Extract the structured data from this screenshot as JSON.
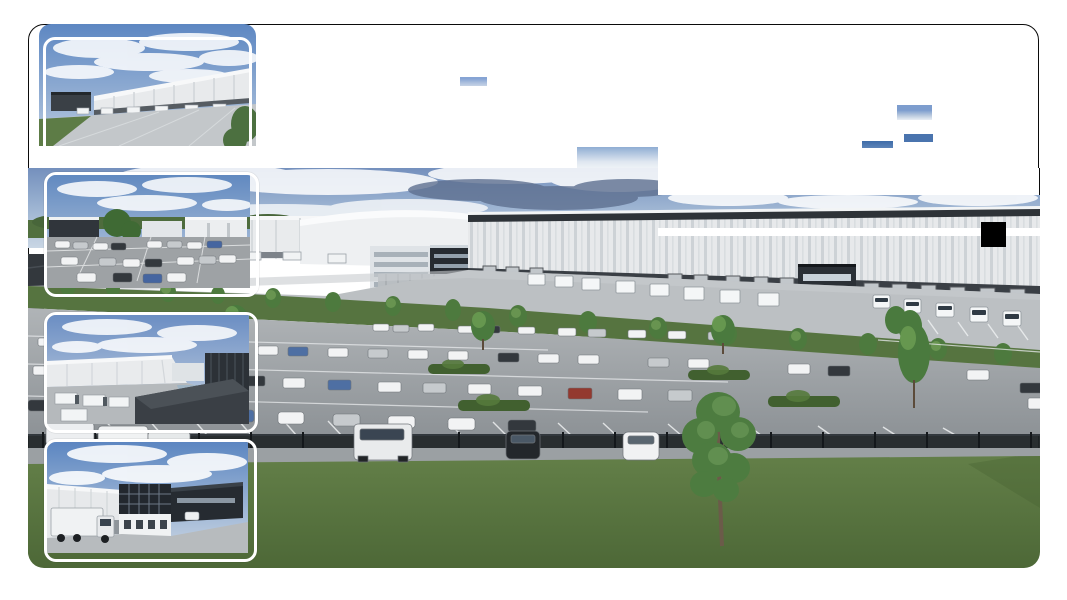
{
  "page": {
    "background": "#ffffff",
    "state": "image gallery partially loaded"
  },
  "card": {
    "border_color": "#0b0b0b",
    "corner_radius_px": 16
  },
  "gallery": {
    "main_image": {
      "label": "Aerial rendering of a logistics park: white warehouse with truck docks, dark office building, full car park, perimeter fence, lawn with large tree",
      "status": "partially loaded"
    },
    "thumbnails": [
      {
        "label": "Warehouse with loading docks and concrete apron under blue sky"
      },
      {
        "label": "Car park with distant industrial buildings and trees"
      },
      {
        "label": "Truck yard with white warehouse and dark flat-roof building"
      },
      {
        "label": "Loading yard with box truck and three-storey dark office"
      }
    ]
  },
  "palette": {
    "sky_top": "#6d8cba",
    "sky_light": "#c3d2e2",
    "warehouse_white": "#e7e9eb",
    "office_dark": "#23282e",
    "asphalt": "#a3a7aa",
    "grass": "#5a7840",
    "fence": "#202528",
    "artifact_black": "#000000"
  },
  "patches": [
    {
      "name": "sky-fragment-1",
      "parent": "page",
      "x": 460,
      "y": 77,
      "w": 27,
      "h": 9,
      "bg": "linear-gradient(180deg,#86a4d4 20%,#a9bedd 60%,#c6d3e6)"
    },
    {
      "name": "sky-fragment-2",
      "parent": "page",
      "x": 897,
      "y": 105,
      "w": 35,
      "h": 15,
      "bg": "linear-gradient(180deg,#7d9dce 35%,#b9c9de 70%,#e9eef4)"
    },
    {
      "name": "sky-fragment-3",
      "parent": "page",
      "x": 904,
      "y": 134,
      "w": 29,
      "h": 8,
      "bg": "#4a74ae"
    },
    {
      "name": "sky-fragment-4",
      "parent": "page",
      "x": 862,
      "y": 141,
      "w": 31,
      "h": 7,
      "bg": "linear-gradient(180deg,#3e6ca9,#5d84b8)"
    },
    {
      "name": "sky-tile",
      "parent": "page",
      "x": 577,
      "y": 147,
      "w": 81,
      "h": 21,
      "bg": "linear-gradient(180deg,#8fadd3,#dfe7f0 70%,#eef2f6)"
    },
    {
      "name": "unloaded-tile-white",
      "parent": "main",
      "x": 630,
      "y": 0,
      "w": 382,
      "h": 27,
      "bg": "#ffffff"
    },
    {
      "name": "loading-stripe",
      "parent": "main",
      "x": 630,
      "y": 60,
      "w": 382,
      "h": 8,
      "bg": "#ffffff"
    },
    {
      "name": "black-square-artifact",
      "parent": "main",
      "x": 953,
      "y": 54,
      "w": 25,
      "h": 25,
      "bg": "#000000"
    },
    {
      "name": "border-segment-right",
      "parent": "main",
      "x": 1010.5,
      "y": 0,
      "w": 1.5,
      "h": 27,
      "bg": "#0b0b0b"
    }
  ]
}
